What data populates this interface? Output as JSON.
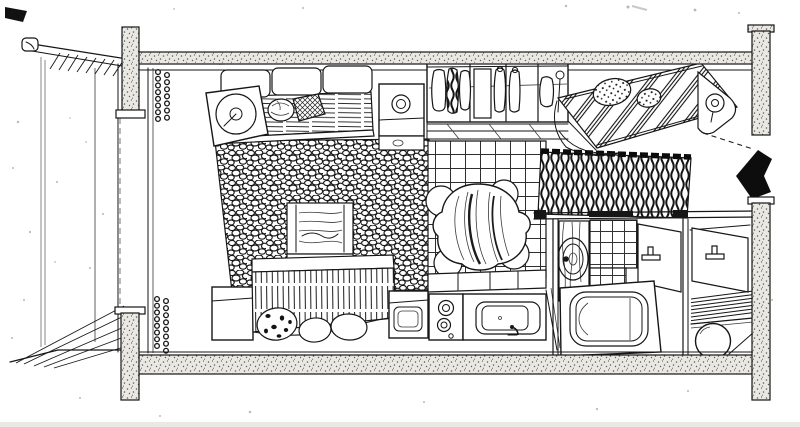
{
  "canvas": {
    "width": 800,
    "height": 427
  },
  "colors": {
    "paper": "#ffffff",
    "ink": "#161616",
    "wall_fill": "#eae8e2",
    "speckle": "#8f897e",
    "arrow_fill": "#0d0d0d",
    "scan_edge": "#d8d4cd"
  }
}
